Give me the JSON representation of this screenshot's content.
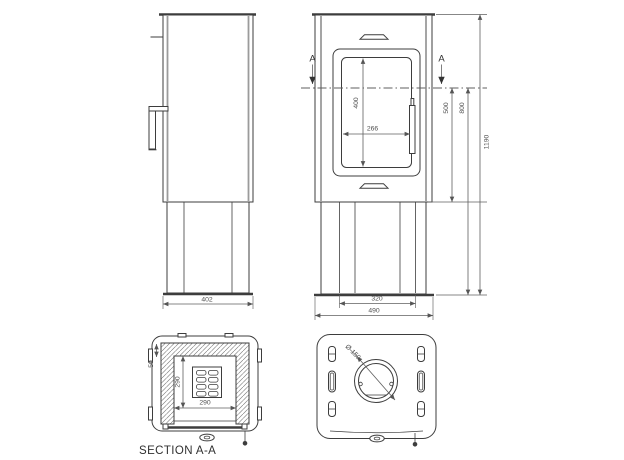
{
  "colors": {
    "line": "#3d3d3d",
    "shade": "#9b9b9b",
    "dim": "#5f5f5f",
    "text": "#4f4f4f",
    "label": "#303030",
    "background": "#ffffff"
  },
  "section_marker": "A",
  "side_view": {
    "base_width_mm": "402"
  },
  "front_view": {
    "glass_width_mm": "266",
    "glass_height_mm": "400",
    "firebox_height_mm": "500",
    "body_height_mm": "800",
    "total_height_mm": "1190",
    "base_inner_width_mm": "320",
    "total_width_mm": "490"
  },
  "section_view": {
    "label": "SECTION A-A",
    "inner_width_mm": "290",
    "inner_depth_mm": "290",
    "wall_gap_mm": "50"
  },
  "top_view": {
    "flue_diameter": "Ø 150"
  }
}
